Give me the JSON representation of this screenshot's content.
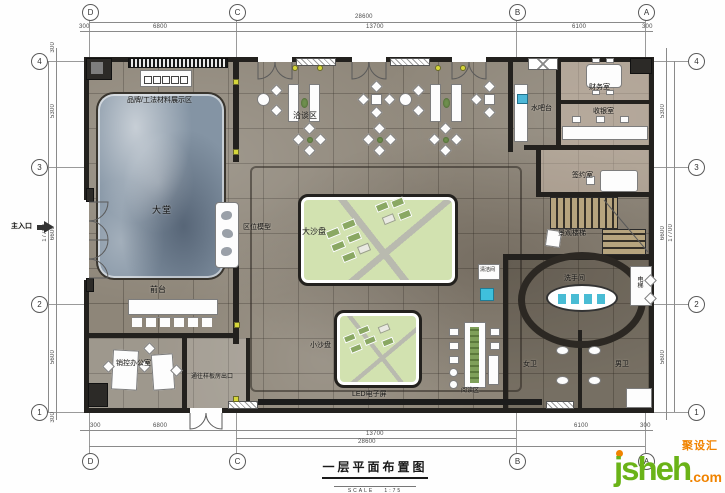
{
  "title": {
    "text": "一层平面布置图",
    "scale_label": "SCALE",
    "scale_value": "1:75"
  },
  "grid": {
    "cols": [
      "D",
      "C",
      "B",
      "A"
    ],
    "rows": [
      "4",
      "3",
      "2",
      "1"
    ]
  },
  "dims": {
    "top": {
      "overall": "28600",
      "segs": [
        "300",
        "6800",
        "13700",
        "6100",
        "300"
      ]
    },
    "bottom": {
      "mid": "13700",
      "overall": "28600",
      "segs": [
        "300",
        "6800",
        "13700",
        "6100",
        "300"
      ]
    },
    "side": {
      "overall": "17700",
      "segs": [
        "300",
        "5300",
        "6600",
        "5600",
        "300"
      ]
    }
  },
  "rooms": {
    "display_area": "品牌/工法材料展示区",
    "negotiation": "洽谈区",
    "water_bar": "水吧台",
    "finance": "财务室",
    "cashier": "收银室",
    "signing": "签约室",
    "lobby": "大堂",
    "location_model": "区位模型",
    "big_sand_table": "大沙盘",
    "reception": "前台",
    "landscape_stairs": "景观楼梯",
    "washroom": "洗手间",
    "elevator": "电梯",
    "small_sand_table": "小沙盘",
    "sales_office": "销控办公室",
    "exit_to_model": "通往样板房出口",
    "led_screen": "LED电子屏",
    "reading_area": "阅读区",
    "women_wc": "女卫",
    "men_wc": "男卫",
    "cleaning": "清洁间",
    "main_entrance": "主入口"
  },
  "watermark": {
    "brand": "jsheh",
    "tld": ".com",
    "cn": "聚设汇"
  },
  "colors": {
    "floor_marble": "#8e8679",
    "rug_blue_marble": "#8494a4",
    "sand_green": "#d2e2b0",
    "wall": "#23211e",
    "marker_yellow": "#d6d63a",
    "sink_cyan": "#49bcd4",
    "watermark_green": "#6ab317",
    "watermark_orange": "#f08300"
  }
}
